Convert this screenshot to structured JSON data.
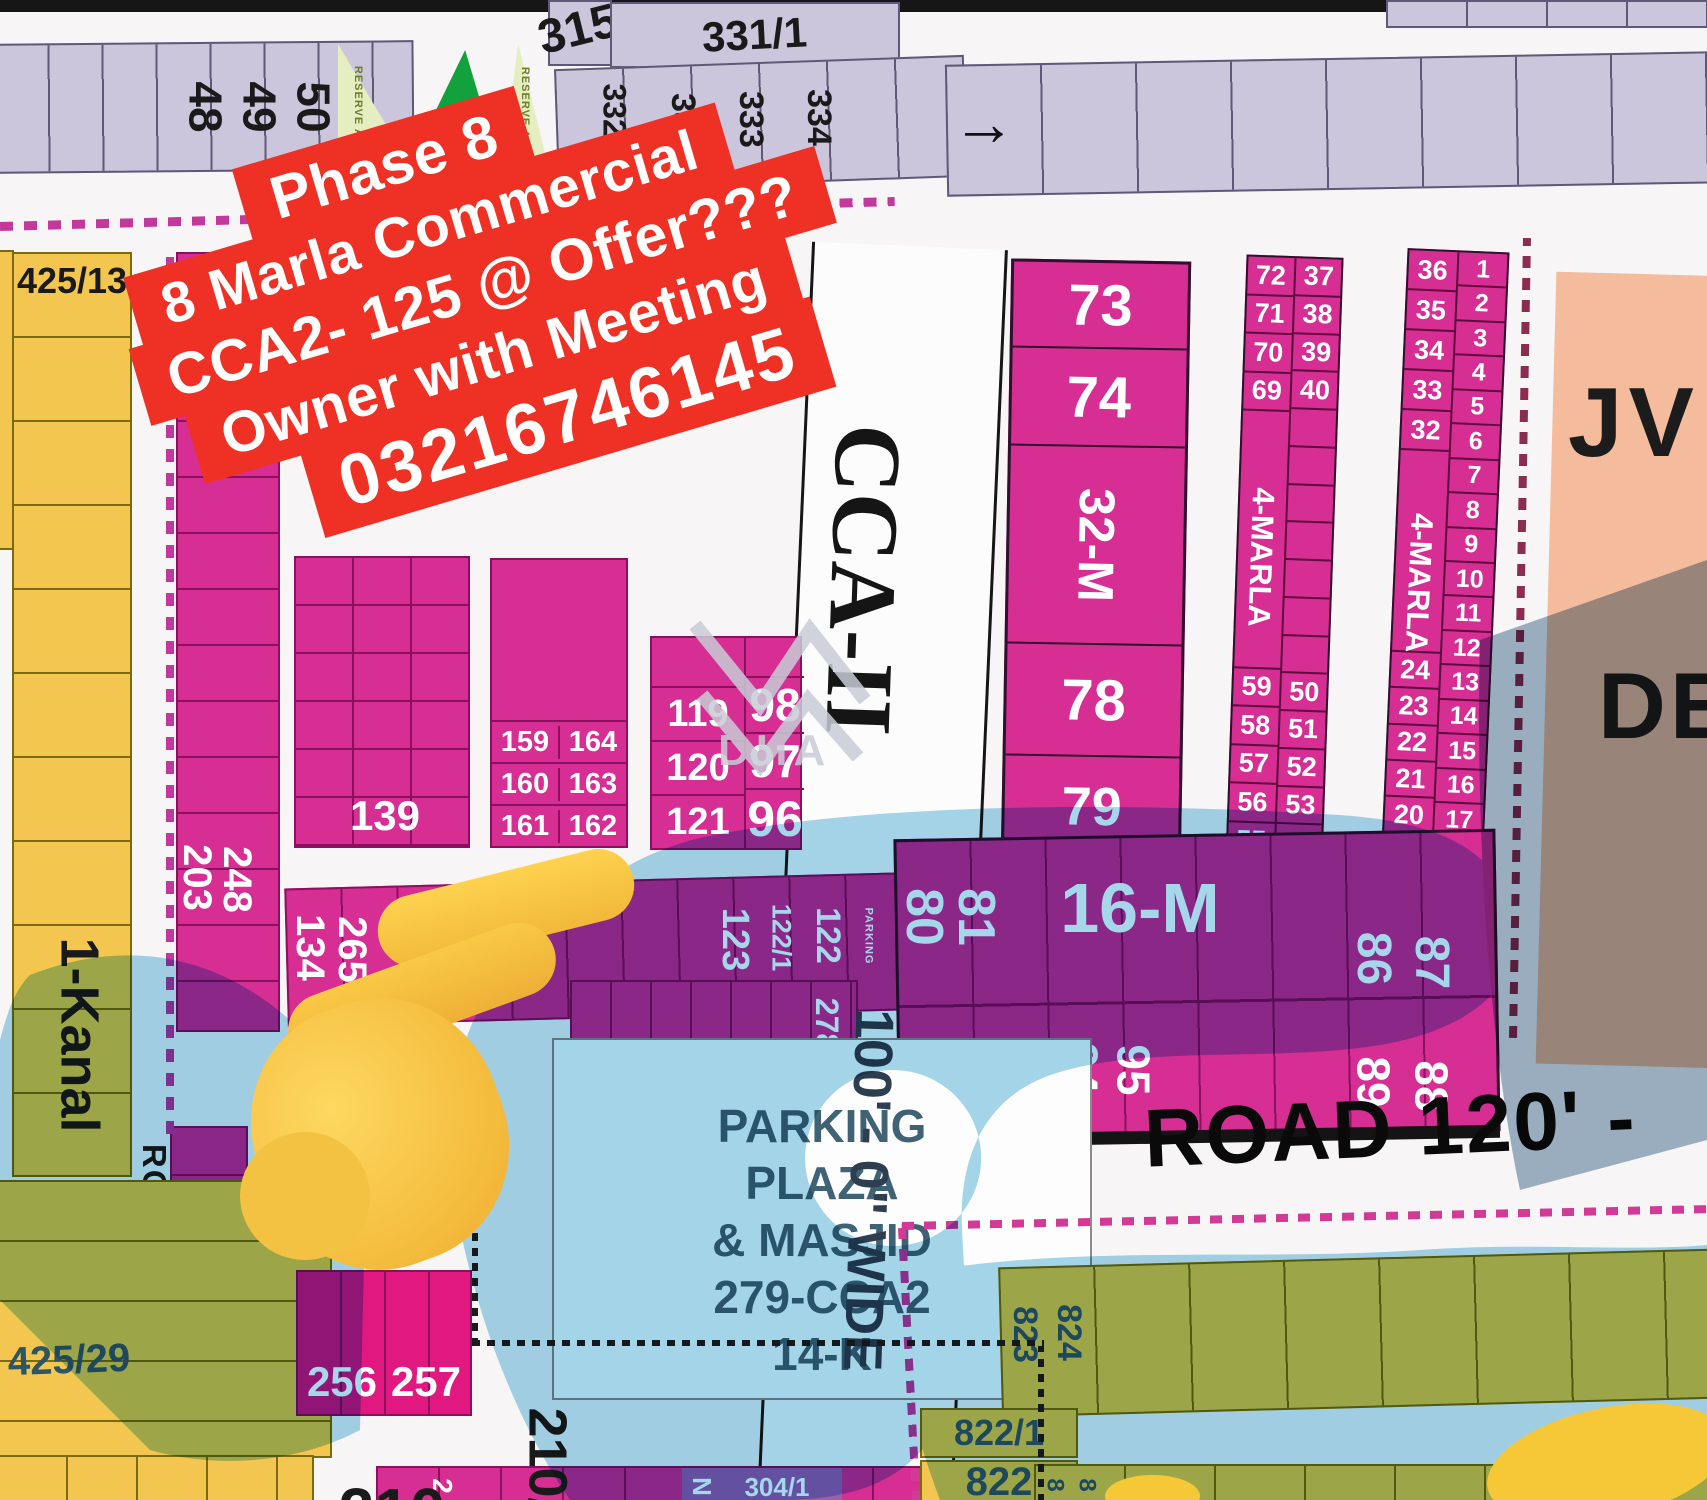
{
  "banner": {
    "l1": "Phase 8",
    "l2": "8 Marla Commercial",
    "l3": "CCA2- 125 @ Offer???",
    "l4": "Owner with Meeting",
    "l5": "03216746145"
  },
  "top": {
    "strip1_plots": [
      "48",
      "49",
      "50"
    ],
    "reserve1": "RESERVE AREA",
    "reserve2": "RESERVE AREA",
    "p315": "315",
    "p331": "331/1",
    "strip2_plots": [
      "332/1",
      "332",
      "333",
      "334"
    ],
    "arrow": "→"
  },
  "left": {
    "p425_13": "425/13",
    "kanal": "1-Kanal",
    "road45": "ROAD 45' WIDE",
    "p425_29": "425/29",
    "p18": "18",
    "p203": "203",
    "p248": "248",
    "p236": "236"
  },
  "center": {
    "p139": "139",
    "rows159": [
      [
        "159",
        "164"
      ],
      [
        "160",
        "163"
      ],
      [
        "161",
        "162"
      ]
    ],
    "col119": [
      "119",
      "120",
      "121"
    ],
    "col96": [
      "98",
      "97",
      "96"
    ],
    "p134": "134",
    "p265": "265",
    "p123": "123",
    "p122_1": "122/1",
    "p122": "122",
    "parking_sm": "PARKING",
    "p278": "278",
    "p256": "256",
    "p257": "257"
  },
  "cca": {
    "name": "CCA-II",
    "width": "100' - 0\" WIDE"
  },
  "block73": {
    "c1": "73",
    "c2": "74",
    "c3": "32-M",
    "c4": "78",
    "c5": "79"
  },
  "marla1": {
    "label": "4-MARLA",
    "lt": [
      "72",
      "71",
      "70",
      "69"
    ],
    "lb": [
      "59",
      "58",
      "57",
      "56",
      "55"
    ],
    "rt": [
      "37",
      "38",
      "39",
      "40"
    ],
    "rb": [
      "50",
      "51",
      "52",
      "53",
      "54"
    ]
  },
  "marla2": {
    "label": "4-MARLA",
    "lt": [
      "36",
      "35",
      "34",
      "33",
      "32"
    ],
    "lb": [
      "24",
      "23",
      "22",
      "21",
      "20",
      "19"
    ],
    "rt": [
      "1",
      "2",
      "3",
      "4",
      "5",
      "6",
      "7",
      "8",
      "9",
      "10",
      "11",
      "12",
      "13",
      "14",
      "15",
      "16",
      "17",
      "18"
    ]
  },
  "m16": {
    "label": "16-M",
    "p80": "80",
    "p81": "81",
    "p86": "86",
    "p87": "87",
    "p94": "94",
    "p95": "95",
    "p89": "89",
    "p88": "88"
  },
  "roads": {
    "r120": "ROAD 120' -"
  },
  "parking": {
    "l1": "PARKING",
    "l2": "PLAZA",
    "l3": "& MASJID",
    "l4": "279-CCA2",
    "l5": "14-K"
  },
  "right": {
    "jv": "JV",
    "de": "DE"
  },
  "bottom": {
    "p210": "210",
    "p210r": "210/",
    "p2": "2",
    "pn": "N",
    "p304": "304/1",
    "p823": "823",
    "p824": "824",
    "p822_1": "822/1",
    "p822": "822",
    "p8a": "8",
    "p8b": "8"
  },
  "watermark": {
    "text": "DHA"
  },
  "colors": {
    "magenta": "#d62e93",
    "crimson": "#e0187f",
    "lavender": "#cbc6db",
    "yellow": "#f2c64f",
    "red": "#ee3124",
    "peach": "#f4bb9c",
    "blue_overlay": "#a5d6ea",
    "park_green": "#12a13c",
    "reserve_green": "#e5eec0",
    "violet": "#9a5fae",
    "pink_dash": "#c2399b",
    "sage_text": "#2e5566"
  }
}
